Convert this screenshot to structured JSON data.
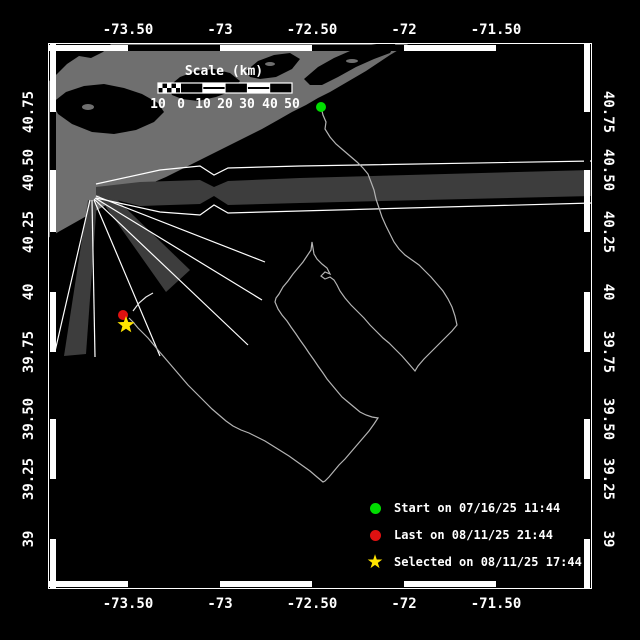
{
  "axes": {
    "top": {
      "y": 30,
      "labels": [
        {
          "text": "-73.50",
          "x": 128
        },
        {
          "text": "-73",
          "x": 220
        },
        {
          "text": "-72.50",
          "x": 312
        },
        {
          "text": "-72",
          "x": 404
        },
        {
          "text": "-71.50",
          "x": 496
        }
      ]
    },
    "bottom": {
      "y": 604,
      "labels": [
        {
          "text": "-73.50",
          "x": 128
        },
        {
          "text": "-73",
          "x": 220
        },
        {
          "text": "-72.50",
          "x": 312
        },
        {
          "text": "-72",
          "x": 404
        },
        {
          "text": "-71.50",
          "x": 496
        }
      ]
    },
    "left": {
      "x": 29,
      "labels": [
        {
          "text": "40.75",
          "y": 112
        },
        {
          "text": "40.50",
          "y": 170
        },
        {
          "text": "40.25",
          "y": 232
        },
        {
          "text": "40",
          "y": 292
        },
        {
          "text": "39.75",
          "y": 352
        },
        {
          "text": "39.50",
          "y": 419
        },
        {
          "text": "39.25",
          "y": 479
        },
        {
          "text": "39",
          "y": 539
        }
      ]
    },
    "right": {
      "x": 608,
      "labels": [
        {
          "text": "40.75",
          "y": 112
        },
        {
          "text": "40.50",
          "y": 170
        },
        {
          "text": "40.25",
          "y": 232
        },
        {
          "text": "40",
          "y": 292
        },
        {
          "text": "39.75",
          "y": 352
        },
        {
          "text": "39.50",
          "y": 419
        },
        {
          "text": "39.25",
          "y": 479
        },
        {
          "text": "39",
          "y": 539
        }
      ]
    }
  },
  "frame": {
    "x0": 48,
    "y0": 43,
    "x1": 592,
    "y1": 589,
    "xticks": [
      128,
      220,
      312,
      404,
      496
    ],
    "yticks": [
      112,
      170,
      232,
      292,
      352,
      419,
      479,
      539
    ]
  },
  "scale_bar": {
    "title": "Scale (km)",
    "x": 158,
    "y": 83,
    "w": 134,
    "h": 10,
    "sub_w": 22.5,
    "cells": [
      "black",
      "striped",
      "black",
      "striped",
      "black"
    ],
    "label_y": 97,
    "labels": [
      {
        "text": "10",
        "x": 158
      },
      {
        "text": "0",
        "x": 181
      },
      {
        "text": "10",
        "x": 203
      },
      {
        "text": "20",
        "x": 225
      },
      {
        "text": "30",
        "x": 247
      },
      {
        "text": "40",
        "x": 270
      },
      {
        "text": "50",
        "x": 292
      }
    ]
  },
  "legend": {
    "x": 364,
    "ys": [
      508,
      535,
      562
    ],
    "items": [
      {
        "shape": "circle",
        "color": "#00dd00",
        "name": "start",
        "label": "Start on 07/16/25 11:44"
      },
      {
        "shape": "circle",
        "color": "#e01111",
        "name": "last",
        "label": "Last on 08/11/25 21:44"
      },
      {
        "shape": "star",
        "color": "#ffe400",
        "name": "selected",
        "label": "Selected on 08/11/25 17:44"
      }
    ]
  },
  "map": {
    "colors": {
      "sea": "#000000",
      "land": "#6f6f6f",
      "beam": "#3d3d3d",
      "track": "#b4b4b4",
      "line": "#ffffff"
    },
    "land": [
      [
        48,
        238
      ],
      [
        60,
        231
      ],
      [
        76,
        222
      ],
      [
        90,
        214
      ],
      [
        106,
        205
      ],
      [
        122,
        197
      ],
      [
        136,
        191
      ],
      [
        152,
        183
      ],
      [
        166,
        177
      ],
      [
        182,
        169
      ],
      [
        198,
        161
      ],
      [
        214,
        153
      ],
      [
        230,
        145
      ],
      [
        246,
        137
      ],
      [
        262,
        129
      ],
      [
        278,
        120
      ],
      [
        292,
        112
      ],
      [
        306,
        105
      ],
      [
        318,
        98
      ],
      [
        330,
        92
      ],
      [
        342,
        85
      ],
      [
        354,
        78
      ],
      [
        366,
        71
      ],
      [
        378,
        63
      ],
      [
        390,
        55
      ],
      [
        400,
        49
      ],
      [
        410,
        43
      ],
      [
        48,
        43
      ]
    ],
    "bays": [
      [
        [
          48,
          43
        ],
        [
          112,
          43
        ],
        [
          103,
          52
        ],
        [
          91,
          58
        ],
        [
          79,
          56
        ],
        [
          67,
          64
        ],
        [
          57,
          74
        ],
        [
          48,
          82
        ]
      ],
      [
        [
          52,
          103
        ],
        [
          66,
          92
        ],
        [
          84,
          86
        ],
        [
          104,
          84
        ],
        [
          124,
          88
        ],
        [
          142,
          94
        ],
        [
          158,
          103
        ],
        [
          164,
          112
        ],
        [
          154,
          122
        ],
        [
          136,
          130
        ],
        [
          114,
          134
        ],
        [
          92,
          132
        ],
        [
          72,
          124
        ],
        [
          58,
          114
        ]
      ],
      [
        [
          168,
          87
        ],
        [
          180,
          77
        ],
        [
          196,
          71
        ],
        [
          214,
          69
        ],
        [
          230,
          73
        ],
        [
          240,
          81
        ],
        [
          232,
          91
        ],
        [
          216,
          97
        ],
        [
          198,
          101
        ],
        [
          182,
          99
        ],
        [
          172,
          95
        ]
      ],
      [
        [
          246,
          71
        ],
        [
          258,
          61
        ],
        [
          274,
          55
        ],
        [
          290,
          53
        ],
        [
          300,
          59
        ],
        [
          292,
          69
        ],
        [
          276,
          77
        ],
        [
          260,
          79
        ],
        [
          250,
          77
        ]
      ],
      [
        [
          304,
          79
        ],
        [
          318,
          67
        ],
        [
          334,
          58
        ],
        [
          350,
          51
        ],
        [
          366,
          46
        ],
        [
          382,
          43
        ],
        [
          396,
          43
        ],
        [
          390,
          53
        ],
        [
          374,
          59
        ],
        [
          356,
          67
        ],
        [
          338,
          77
        ],
        [
          322,
          85
        ],
        [
          310,
          85
        ]
      ]
    ],
    "islands": [
      [
        88,
        107,
        6,
        3
      ],
      [
        270,
        64,
        5,
        2
      ],
      [
        352,
        61,
        6,
        2
      ]
    ],
    "beams": {
      "band": [
        [
          96,
          187
        ],
        [
          140,
          182
        ],
        [
          200,
          180
        ],
        [
          214,
          187
        ],
        [
          228,
          181
        ],
        [
          300,
          178
        ],
        [
          592,
          170
        ],
        [
          592,
          196
        ],
        [
          300,
          203
        ],
        [
          228,
          205
        ],
        [
          214,
          196
        ],
        [
          200,
          204
        ],
        [
          140,
          206
        ],
        [
          96,
          195
        ]
      ],
      "band_top": [
        [
          96,
          184
        ],
        [
          160,
          170
        ],
        [
          200,
          166
        ],
        [
          214,
          175
        ],
        [
          228,
          168
        ],
        [
          300,
          166
        ],
        [
          592,
          161
        ]
      ],
      "band_bottom": [
        [
          96,
          198
        ],
        [
          160,
          212
        ],
        [
          200,
          215
        ],
        [
          214,
          205
        ],
        [
          228,
          213
        ],
        [
          300,
          211
        ],
        [
          592,
          203
        ]
      ],
      "rays": [
        [
          [
            96,
            196
          ],
          [
            265,
            262
          ]
        ],
        [
          [
            95,
            198
          ],
          [
            262,
            300
          ]
        ],
        [
          [
            94,
            199
          ],
          [
            248,
            345
          ]
        ],
        [
          [
            94,
            200
          ],
          [
            160,
            356
          ]
        ],
        [
          [
            92,
            200
          ],
          [
            95,
            357
          ]
        ],
        [
          [
            90,
            200
          ],
          [
            53,
            360
          ]
        ]
      ],
      "wedges": [
        [
          [
            99,
            197
          ],
          [
            108,
            191
          ],
          [
            190,
            270
          ],
          [
            166,
            292
          ]
        ],
        [
          [
            88,
            200
          ],
          [
            97,
            201
          ],
          [
            86,
            354
          ],
          [
            64,
            356
          ]
        ]
      ]
    },
    "track": {
      "points": [
        [
          321,
          107
        ],
        [
          323,
          115
        ],
        [
          326,
          122
        ],
        [
          325,
          129
        ],
        [
          330,
          137
        ],
        [
          336,
          144
        ],
        [
          343,
          150
        ],
        [
          350,
          156
        ],
        [
          357,
          162
        ],
        [
          363,
          168
        ],
        [
          368,
          174
        ],
        [
          371,
          182
        ],
        [
          374,
          190
        ],
        [
          376,
          199
        ],
        [
          379,
          208
        ],
        [
          382,
          217
        ],
        [
          386,
          226
        ],
        [
          390,
          234
        ],
        [
          394,
          242
        ],
        [
          399,
          249
        ],
        [
          405,
          255
        ],
        [
          412,
          260
        ],
        [
          419,
          265
        ],
        [
          425,
          271
        ],
        [
          431,
          277
        ],
        [
          437,
          284
        ],
        [
          443,
          291
        ],
        [
          448,
          299
        ],
        [
          452,
          307
        ],
        [
          455,
          316
        ],
        [
          457,
          325
        ],
        [
          452,
          331
        ],
        [
          445,
          338
        ],
        [
          438,
          345
        ],
        [
          431,
          352
        ],
        [
          424,
          359
        ],
        [
          418,
          366
        ],
        [
          415,
          371
        ],
        [
          409,
          364
        ],
        [
          402,
          356
        ],
        [
          395,
          349
        ],
        [
          389,
          343
        ],
        [
          383,
          338
        ],
        [
          377,
          332
        ],
        [
          370,
          325
        ],
        [
          364,
          318
        ],
        [
          357,
          311
        ],
        [
          351,
          305
        ],
        [
          345,
          298
        ],
        [
          340,
          291
        ],
        [
          337,
          285
        ],
        [
          334,
          280
        ],
        [
          330,
          277
        ],
        [
          325,
          279
        ],
        [
          321,
          276
        ],
        [
          325,
          272
        ],
        [
          330,
          274
        ],
        [
          327,
          268
        ],
        [
          322,
          264
        ],
        [
          317,
          259
        ],
        [
          314,
          254
        ],
        [
          313,
          248
        ],
        [
          312,
          242
        ],
        [
          311,
          250
        ],
        [
          307,
          256
        ],
        [
          303,
          262
        ],
        [
          298,
          268
        ],
        [
          293,
          274
        ],
        [
          288,
          281
        ],
        [
          283,
          287
        ],
        [
          279,
          294
        ],
        [
          276,
          298
        ],
        [
          275,
          302
        ],
        [
          278,
          309
        ],
        [
          282,
          315
        ],
        [
          287,
          321
        ],
        [
          291,
          327
        ],
        [
          296,
          334
        ],
        [
          300,
          340
        ],
        [
          305,
          347
        ],
        [
          309,
          353
        ],
        [
          314,
          360
        ],
        [
          318,
          366
        ],
        [
          323,
          373
        ],
        [
          327,
          379
        ],
        [
          332,
          385
        ],
        [
          337,
          391
        ],
        [
          342,
          397
        ],
        [
          348,
          402
        ],
        [
          354,
          407
        ],
        [
          360,
          412
        ],
        [
          366,
          415
        ],
        [
          372,
          417
        ],
        [
          378,
          418
        ],
        [
          374,
          424
        ],
        [
          369,
          431
        ],
        [
          363,
          438
        ],
        [
          357,
          445
        ],
        [
          351,
          452
        ],
        [
          345,
          459
        ],
        [
          339,
          465
        ],
        [
          334,
          471
        ],
        [
          329,
          477
        ],
        [
          325,
          481
        ],
        [
          323,
          482
        ],
        [
          317,
          477
        ],
        [
          310,
          471
        ],
        [
          303,
          466
        ],
        [
          296,
          461
        ],
        [
          289,
          456
        ],
        [
          281,
          451
        ],
        [
          273,
          446
        ],
        [
          265,
          441
        ],
        [
          257,
          437
        ],
        [
          249,
          433
        ],
        [
          241,
          430
        ],
        [
          233,
          426
        ],
        [
          226,
          421
        ],
        [
          219,
          415
        ],
        [
          212,
          409
        ],
        [
          206,
          403
        ],
        [
          200,
          397
        ],
        [
          194,
          391
        ],
        [
          188,
          385
        ],
        [
          182,
          378
        ],
        [
          176,
          371
        ],
        [
          170,
          364
        ],
        [
          164,
          357
        ],
        [
          158,
          350
        ],
        [
          153,
          344
        ],
        [
          148,
          338
        ],
        [
          143,
          333
        ],
        [
          138,
          328
        ],
        [
          133,
          322
        ],
        [
          129,
          318
        ]
      ],
      "stub": [
        [
          133,
          311
        ],
        [
          139,
          303
        ],
        [
          146,
          297
        ],
        [
          153,
          293
        ]
      ]
    },
    "markers": {
      "start": {
        "x": 321,
        "y": 107,
        "r": 5,
        "color": "#00dd00"
      },
      "last": {
        "x": 123,
        "y": 315,
        "r": 5,
        "color": "#e01111"
      },
      "selected": {
        "x": 126,
        "y": 325,
        "r": 9,
        "color": "#ffe400"
      }
    }
  }
}
